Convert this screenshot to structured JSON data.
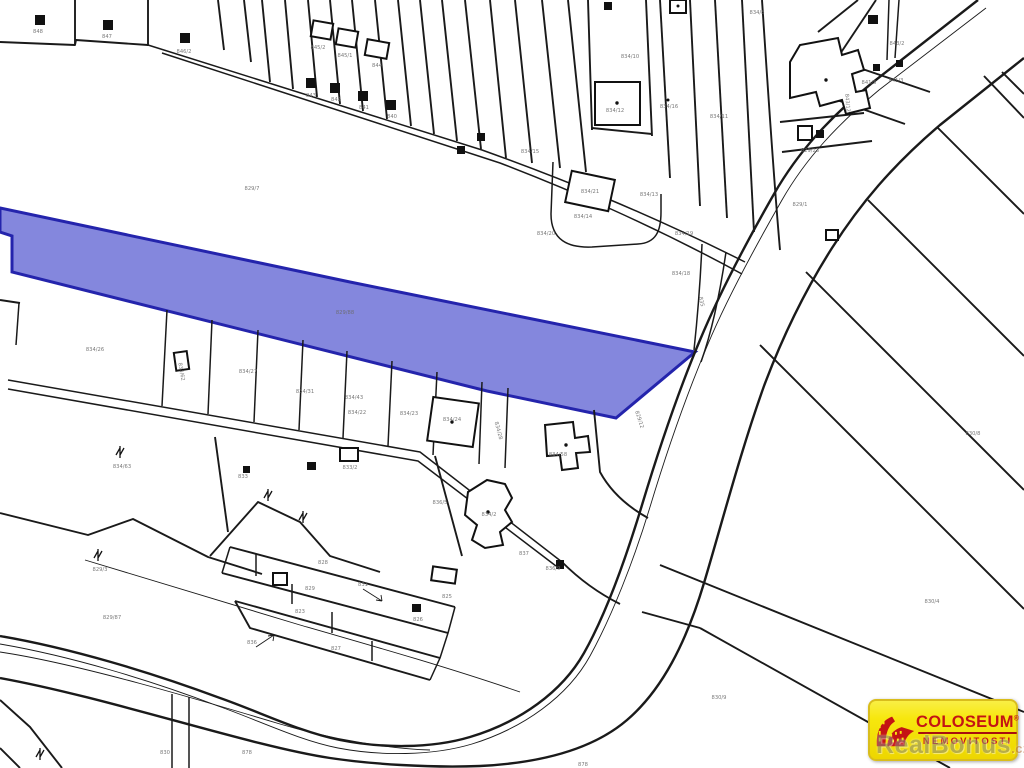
{
  "colors": {
    "highlight_fill": "#8487dd",
    "highlight_stroke": "#2424ac",
    "boundary": "#1a1a1a",
    "label": "#6b6b6b",
    "logo_bg": "#f7e70e",
    "logo_red": "#c41414",
    "watermark": "#8a8a82"
  },
  "map": {
    "type": "cadastral-parcel-map",
    "highlighted_parcel_label": "829/88",
    "labels": [
      {
        "t": "848",
        "x": 38,
        "y": 33
      },
      {
        "t": "847",
        "x": 107,
        "y": 38
      },
      {
        "t": "846/2",
        "x": 184,
        "y": 53
      },
      {
        "t": "845/2",
        "x": 318,
        "y": 49
      },
      {
        "t": "845/1",
        "x": 345,
        "y": 57
      },
      {
        "t": "844",
        "x": 377,
        "y": 67
      },
      {
        "t": "843",
        "x": 311,
        "y": 97
      },
      {
        "t": "842",
        "x": 336,
        "y": 101
      },
      {
        "t": "841",
        "x": 364,
        "y": 109
      },
      {
        "t": "840",
        "x": 392,
        "y": 118
      },
      {
        "t": "829/7",
        "x": 252,
        "y": 190
      },
      {
        "t": "834/10",
        "x": 630,
        "y": 58
      },
      {
        "t": "834/12",
        "x": 615,
        "y": 112
      },
      {
        "t": "834/16",
        "x": 669,
        "y": 108
      },
      {
        "t": "834/11",
        "x": 719,
        "y": 118
      },
      {
        "t": "834/8",
        "x": 757,
        "y": 14
      },
      {
        "t": "834/15",
        "x": 530,
        "y": 153
      },
      {
        "t": "834/21",
        "x": 590,
        "y": 193
      },
      {
        "t": "834/13",
        "x": 649,
        "y": 196
      },
      {
        "t": "834/14",
        "x": 583,
        "y": 218
      },
      {
        "t": "834/20",
        "x": 546,
        "y": 235
      },
      {
        "t": "834/19",
        "x": 684,
        "y": 235
      },
      {
        "t": "834/18",
        "x": 681,
        "y": 275
      },
      {
        "t": "835",
        "x": 700,
        "y": 302,
        "r": 78
      },
      {
        "t": "829/12",
        "x": 638,
        "y": 420,
        "r": 72
      },
      {
        "t": "843/2",
        "x": 897,
        "y": 45
      },
      {
        "t": "841/3",
        "x": 896,
        "y": 82
      },
      {
        "t": "841/5",
        "x": 869,
        "y": 84
      },
      {
        "t": "843/12",
        "x": 846,
        "y": 103,
        "r": 85
      },
      {
        "t": "829/23",
        "x": 810,
        "y": 152
      },
      {
        "t": "829/1",
        "x": 800,
        "y": 206
      },
      {
        "t": "829/88",
        "x": 345,
        "y": 314
      },
      {
        "t": "834/26",
        "x": 95,
        "y": 351
      },
      {
        "t": "834/62",
        "x": 180,
        "y": 372,
        "r": 80
      },
      {
        "t": "834/27",
        "x": 248,
        "y": 373
      },
      {
        "t": "834/31",
        "x": 305,
        "y": 393
      },
      {
        "t": "834/43",
        "x": 354,
        "y": 399
      },
      {
        "t": "834/22",
        "x": 357,
        "y": 414
      },
      {
        "t": "834/23",
        "x": 409,
        "y": 415
      },
      {
        "t": "834/24",
        "x": 452,
        "y": 421
      },
      {
        "t": "834/28",
        "x": 497,
        "y": 431,
        "r": 75
      },
      {
        "t": "834/58",
        "x": 558,
        "y": 456
      },
      {
        "t": "834/63",
        "x": 122,
        "y": 468
      },
      {
        "t": "833",
        "x": 243,
        "y": 478
      },
      {
        "t": "833/2",
        "x": 350,
        "y": 469
      },
      {
        "t": "836/5",
        "x": 440,
        "y": 504
      },
      {
        "t": "834/2",
        "x": 489,
        "y": 516
      },
      {
        "t": "837",
        "x": 524,
        "y": 555
      },
      {
        "t": "836/9",
        "x": 553,
        "y": 570
      },
      {
        "t": "829/3",
        "x": 100,
        "y": 571
      },
      {
        "t": "829/87",
        "x": 112,
        "y": 619
      },
      {
        "t": "836",
        "x": 252,
        "y": 644
      },
      {
        "t": "828",
        "x": 323,
        "y": 564
      },
      {
        "t": "829",
        "x": 310,
        "y": 590
      },
      {
        "t": "823",
        "x": 300,
        "y": 613
      },
      {
        "t": "827",
        "x": 336,
        "y": 650
      },
      {
        "t": "826",
        "x": 418,
        "y": 621
      },
      {
        "t": "825",
        "x": 447,
        "y": 598
      },
      {
        "t": "831",
        "x": 363,
        "y": 586
      },
      {
        "t": "830",
        "x": 165,
        "y": 754
      },
      {
        "t": "878",
        "x": 247,
        "y": 754
      },
      {
        "t": "878",
        "x": 583,
        "y": 766
      },
      {
        "t": "830/4",
        "x": 932,
        "y": 603
      },
      {
        "t": "830/8",
        "x": 973,
        "y": 435
      },
      {
        "t": "830/9",
        "x": 719,
        "y": 699
      }
    ]
  },
  "watermark": {
    "text": "RealBonus",
    "suffix": ".cz"
  },
  "logo": {
    "brand": "COLOSEUM",
    "registered": "®",
    "subtitle": "NEMOVITOSTI",
    "icon": "colosseum-icon"
  }
}
